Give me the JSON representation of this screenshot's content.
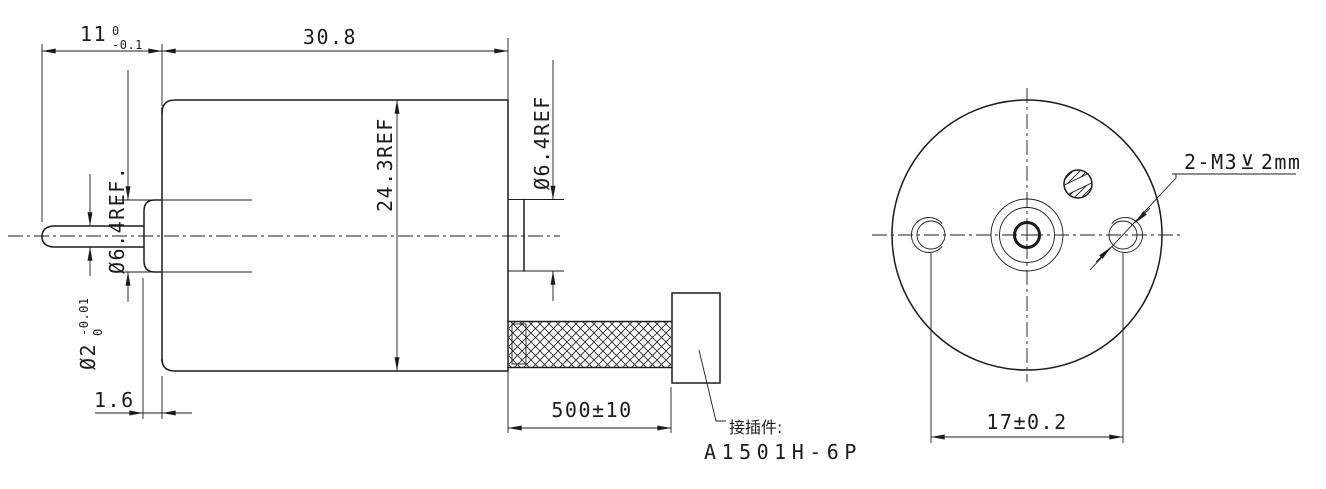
{
  "drawing": {
    "background": "#ffffff",
    "line_color": "#1c1c1c",
    "side_view": {
      "dim_front_section": {
        "value": "11",
        "tol_upper": "0",
        "tol_lower": "-0.1"
      },
      "dim_body_length": "30.8",
      "dia_front_bushing": "Ø6.4REF.",
      "dia_shaft": {
        "value": "Ø2",
        "tol_upper": "0",
        "tol_lower": "-0.01"
      },
      "dia_body": "24.3REF",
      "dia_rear_boss": "Ø6.4REF",
      "dim_bushing_length": "1.6",
      "dim_cable_length": "500±10",
      "connector_note_cn": "接插件:",
      "connector_model": "A1501H-6P"
    },
    "end_view": {
      "thread_callout": {
        "prefix": "2-M3",
        "depth_symbol": "⊻",
        "depth": "2mm"
      },
      "dim_hole_spacing": "17±0.2"
    }
  }
}
